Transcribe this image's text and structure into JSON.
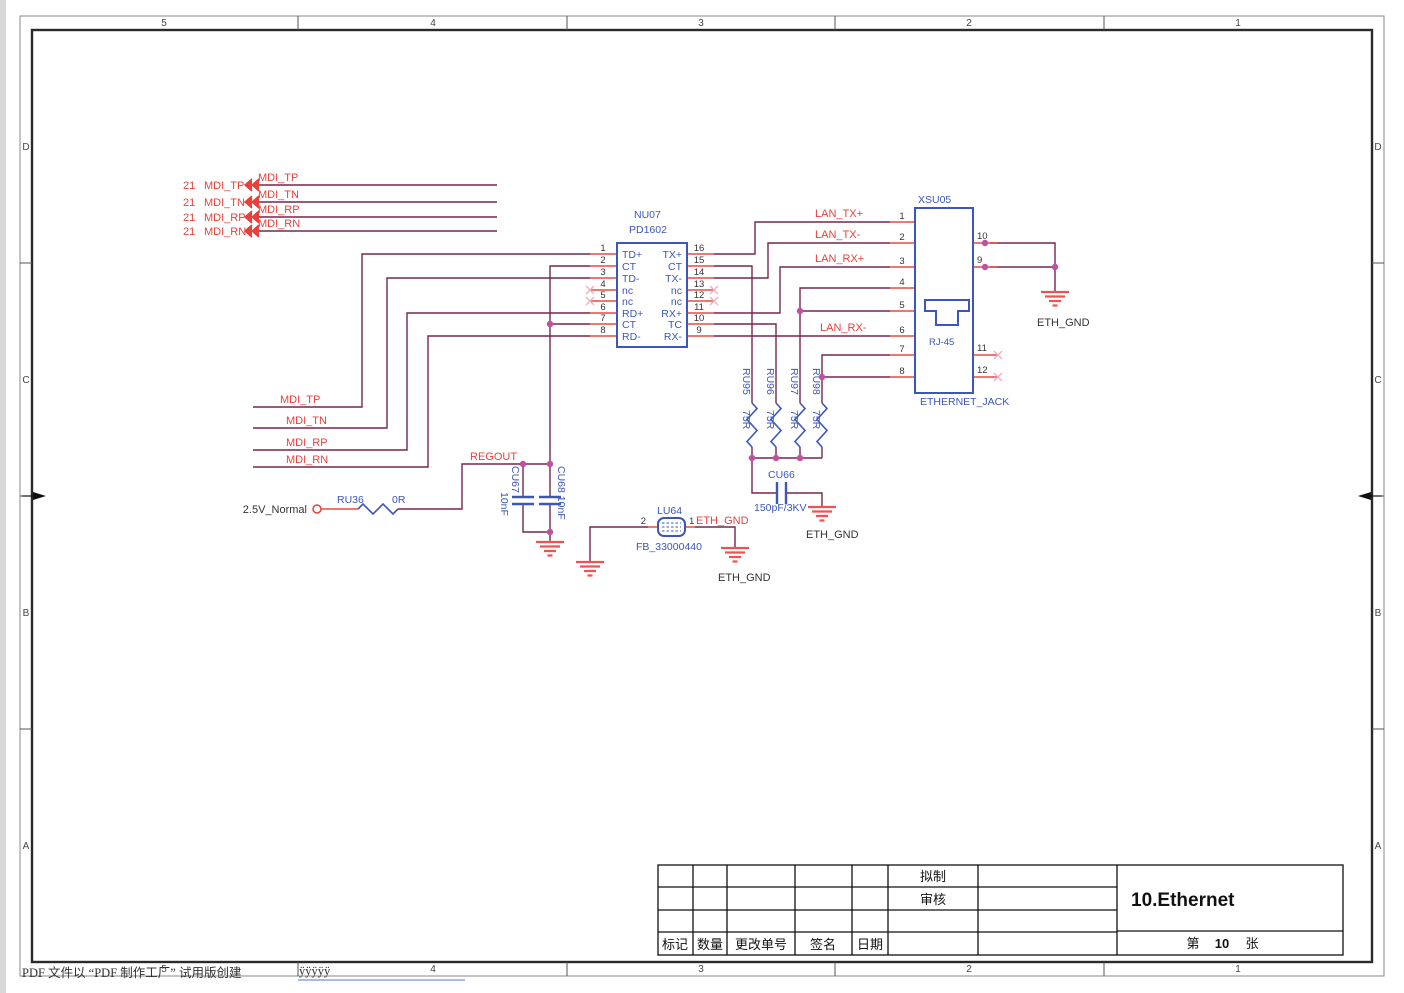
{
  "sheet": {
    "grid_cols": [
      "5",
      "4",
      "3",
      "2",
      "1"
    ],
    "grid_rows": [
      "D",
      "C",
      "B",
      "A"
    ]
  },
  "ports": {
    "ref": "21",
    "nets": [
      "MDI_TP",
      "MDI_TN",
      "MDI_RP",
      "MDI_RN"
    ]
  },
  "transformer": {
    "designator": "NU07",
    "part": "PD1602",
    "left_pins": [
      {
        "num": "1",
        "name": "TD+"
      },
      {
        "num": "2",
        "name": "CT"
      },
      {
        "num": "3",
        "name": "TD-"
      },
      {
        "num": "4",
        "name": "nc"
      },
      {
        "num": "5",
        "name": "nc"
      },
      {
        "num": "6",
        "name": "RD+"
      },
      {
        "num": "7",
        "name": "CT"
      },
      {
        "num": "8",
        "name": "RD-"
      }
    ],
    "right_pins": [
      {
        "num": "16",
        "name": "TX+"
      },
      {
        "num": "15",
        "name": "CT"
      },
      {
        "num": "14",
        "name": "TX-"
      },
      {
        "num": "13",
        "name": "nc"
      },
      {
        "num": "12",
        "name": "nc"
      },
      {
        "num": "11",
        "name": "RX+"
      },
      {
        "num": "10",
        "name": "TC"
      },
      {
        "num": "9",
        "name": "RX-"
      }
    ]
  },
  "jack": {
    "designator": "XSU05",
    "label": "ETHERNET_JACK",
    "icon_label": "RJ-45",
    "left_pins": [
      "1",
      "2",
      "3",
      "4",
      "5",
      "6",
      "7",
      "8"
    ],
    "right_pins": [
      "10",
      "9",
      "11",
      "12"
    ]
  },
  "nets": {
    "lan": [
      "LAN_TX+",
      "LAN_TX-",
      "LAN_RX+",
      "LAN_RX-"
    ],
    "regout": "REGOUT",
    "eth_gnd": "ETH_GND",
    "power": "2.5V_Normal"
  },
  "resistors": {
    "termination": [
      {
        "ref": "RU95",
        "value": "75R"
      },
      {
        "ref": "RU96",
        "value": "75R"
      },
      {
        "ref": "RU97",
        "value": "75R"
      },
      {
        "ref": "RU98",
        "value": "75R"
      }
    ],
    "series": {
      "ref": "RU36",
      "value": "0R"
    }
  },
  "capacitors": {
    "cu67": {
      "ref": "CU67",
      "value": "10nF"
    },
    "cu68": {
      "label": "CU68 10nF"
    },
    "cu66": {
      "ref": "CU66",
      "value": "150pF/3KV"
    }
  },
  "ferrite_bead": {
    "ref": "LU64",
    "part": "FB_33000440",
    "pin_left": "2",
    "pin_right": "1"
  },
  "titleblock": {
    "drafted": "拟制",
    "reviewed": "审核",
    "mark": "标记",
    "quantity": "数量",
    "change_order": "更改单号",
    "signature": "签名",
    "date": "日期",
    "title": "10.Ethernet",
    "sheet_word_left": "第",
    "sheet_number": "10",
    "sheet_word_right": "张"
  },
  "footer": {
    "note": "PDF 文件以 “PDF 制作工厂” 试用版创建",
    "link": "ÿÿÿÿÿ"
  },
  "colors": {
    "wire": "#74274d",
    "pin_stub": "#e84a42",
    "net_label": "#e8413c",
    "component": "#3c56bb",
    "junction": "#c050a0",
    "ground": "#ef5350",
    "no_connect": "#f2afc0"
  }
}
